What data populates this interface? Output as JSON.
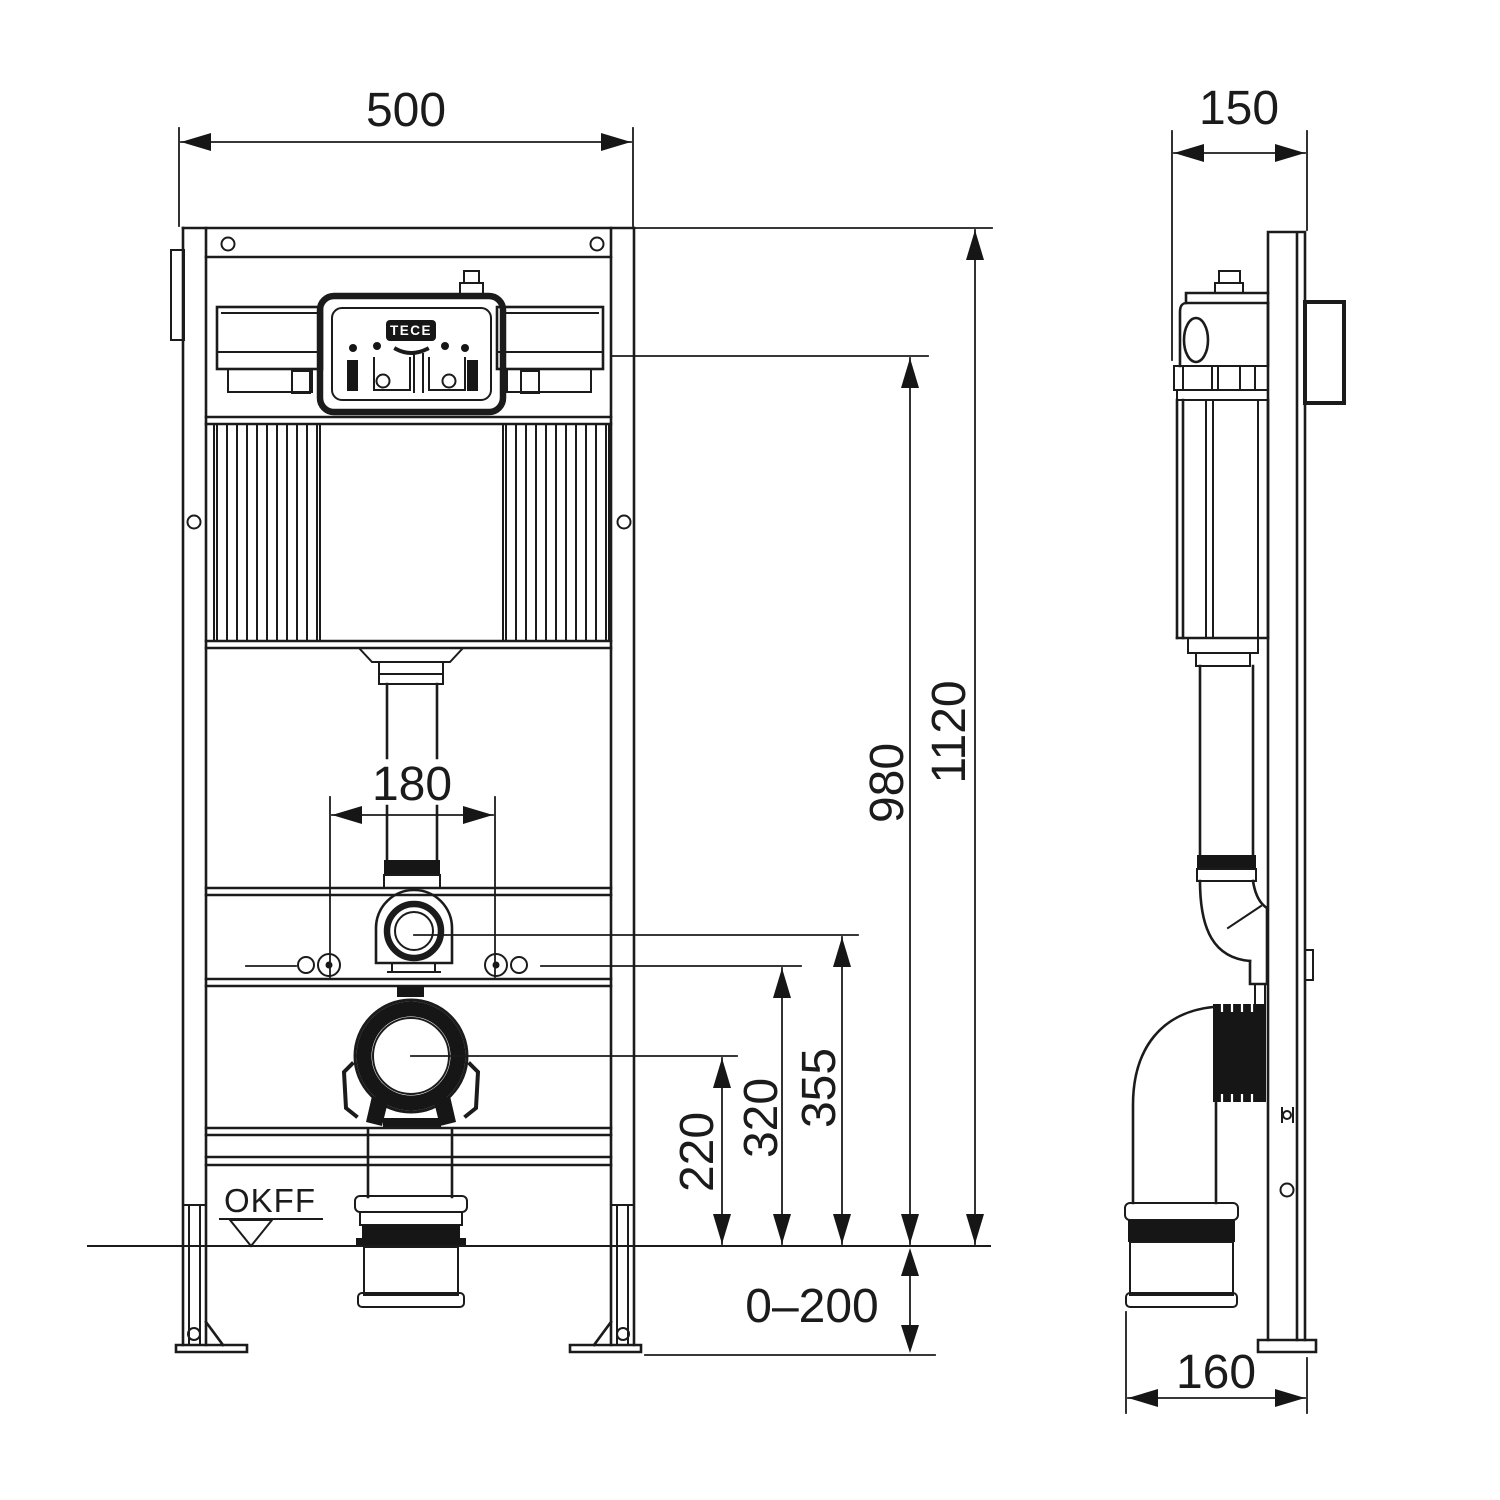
{
  "colors": {
    "line": "#1b1b1b",
    "background": "#ffffff",
    "solid_fill": "#161616"
  },
  "brand": {
    "logo": "TECE"
  },
  "labels": {
    "floor_marker": "OKFF"
  },
  "dimensions": {
    "front_width": "500",
    "side_depth": "150",
    "bolt_spacing": "180",
    "waste_center_height": "220",
    "bolt_height": "320",
    "flush_bend_height": "355",
    "cistern_ref_height": "980",
    "frame_height": "1120",
    "leg_adjustment": "0–200",
    "outlet_offset": "160"
  }
}
